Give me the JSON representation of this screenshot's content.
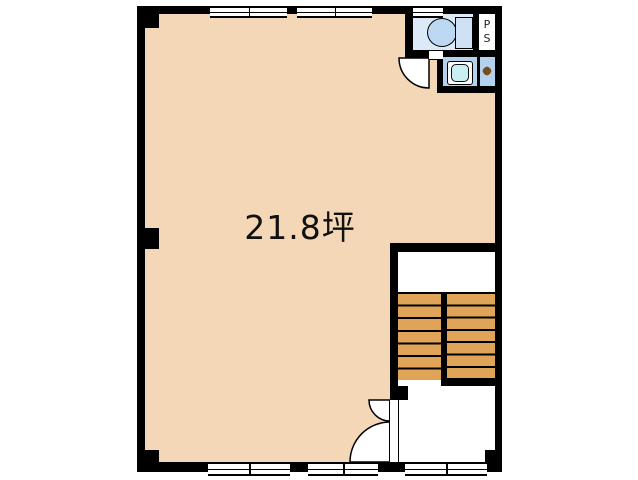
{
  "floorplan": {
    "area_label": "21.8坪",
    "pipe_space": {
      "p": "P",
      "s": "S"
    },
    "rooms": {
      "main_room": "main open floor (21.8 tsubo)",
      "toilet": "WC with toilet fixture",
      "pipe_shaft": "PS",
      "washroom": "hand-wash corridor with basin",
      "staircase": "double-flight staircase",
      "entrance_hall": "entry hall with double-leaf door"
    },
    "counts": {
      "top_windows": 3,
      "bottom_windows": 3,
      "stair_treads_per_flight": 7
    },
    "colors": {
      "floor": "#f4d7b6",
      "stairs": "#e0a458",
      "wc_floor": "#dceaf8",
      "wash_floor": "#b5d2ec",
      "basin": "#c9eef3",
      "fixture": "#bcd8f2",
      "tank": "#cfe2f5",
      "knob": "#7a4a20",
      "wall": "#000000"
    }
  }
}
